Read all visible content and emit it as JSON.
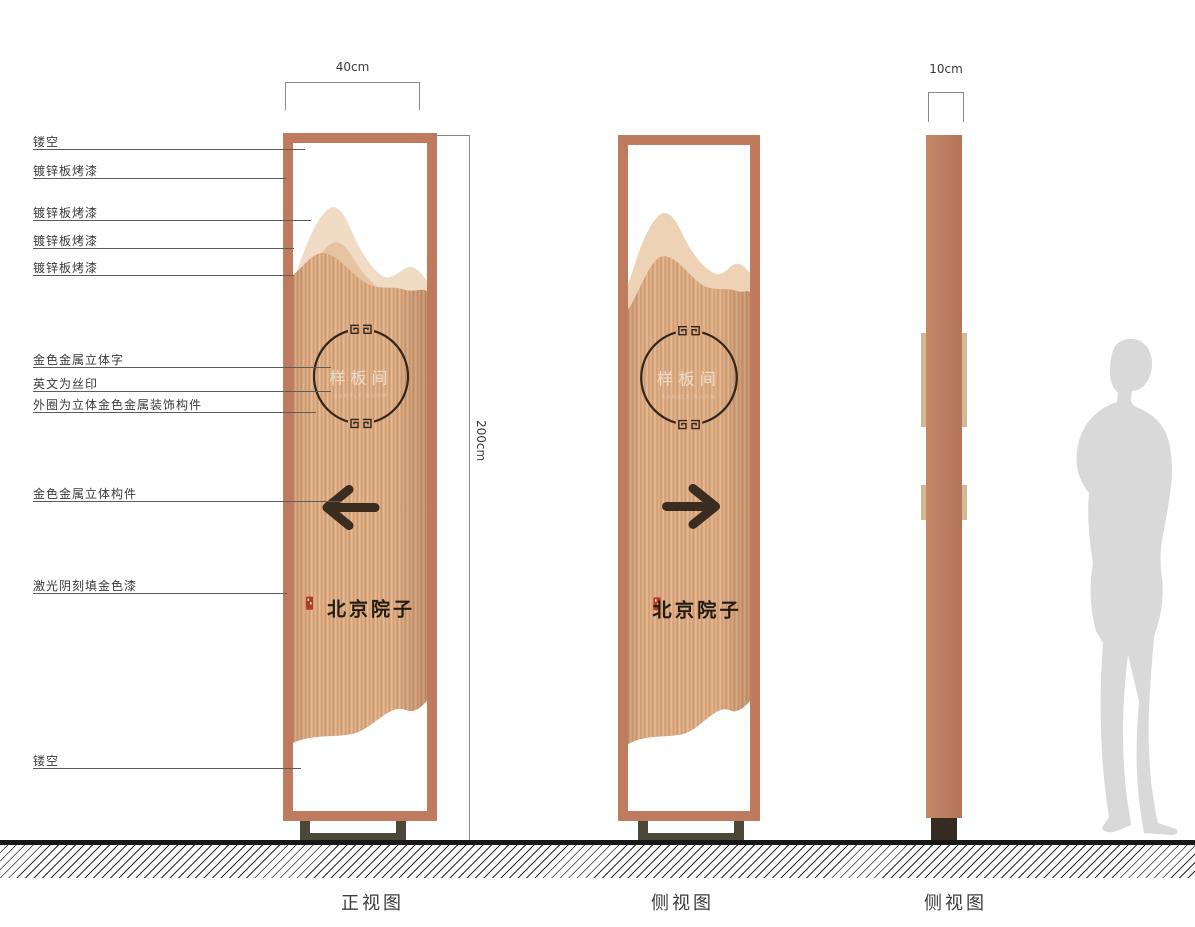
{
  "callouts": [
    "镂空",
    "镀锌板烤漆",
    "镀锌板烤漆",
    "镀锌板烤漆",
    "镀锌板烤漆",
    "金色金属立体字",
    "英文为丝印",
    "外圈为立体金色金属装饰构件",
    "金色金属立体构件",
    "激光阴刻填金色漆",
    "镂空"
  ],
  "dimensions": {
    "width_front": "40cm",
    "height": "200cm",
    "width_side": "10cm"
  },
  "views": {
    "front": "正视图",
    "side1": "侧视图",
    "side2": "侧视图"
  },
  "sign": {
    "plaque_text": "样板间",
    "plaque_subtext": "SAMPLE ROOM",
    "brand_text": "北京院子",
    "arrow_front": "arrow-left-icon",
    "arrow_side": "arrow-right-icon"
  },
  "colors": {
    "frame_copper": "#bf7b5e",
    "panel_copper": "#d9a77e",
    "mountain_light": "#f0dbc4",
    "mountain_mid": "#e8c3a1",
    "arrow_dark": "#3a2c1f",
    "seal_red": "#b23b28",
    "base_olive": "#4b4839",
    "ground_black": "#181818",
    "person_gray": "#d9d9d9"
  }
}
